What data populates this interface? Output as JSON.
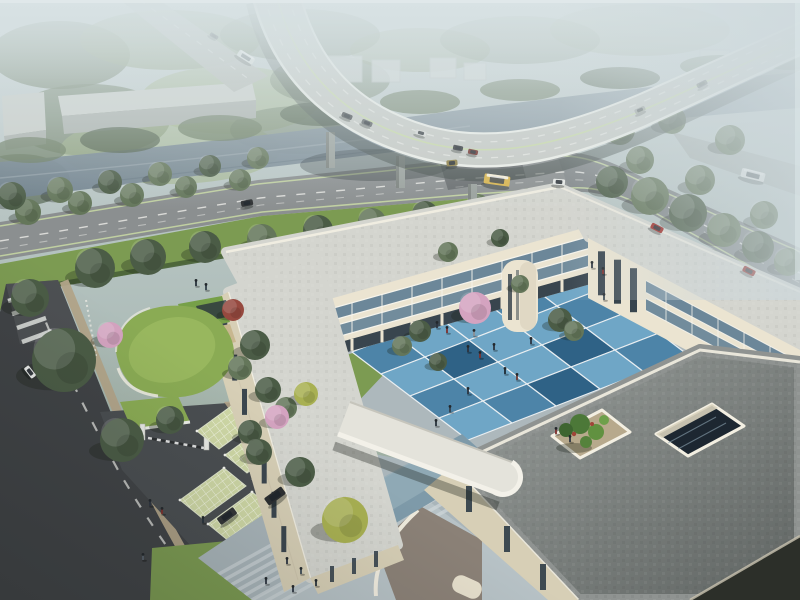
{
  "meta": {
    "type": "aerial-architectural-rendering",
    "subject": "bird's-eye visualization of a three-story cream courtyard building complex with blue checkered courtyard, green roofs, grass-grid parking, riverside forest and a curving highway viaduct with traffic"
  },
  "palette": {
    "haze_top": "#c9d3d5",
    "haze_mid": "#aebdb9",
    "far_green": "#8ea089",
    "tree_dark": "#4b5c46",
    "tree_mid": "#64765a",
    "tree_light": "#7f9166",
    "tree_yellow": "#a8b052",
    "tree_blossom": "#d4a3c0",
    "tree_red": "#96493f",
    "meadow": "#9cb07c",
    "water_light": "#93a2ab",
    "water_dark": "#6f808c",
    "deck": "#c7cac5",
    "deck_edge": "#eef0ea",
    "road_upper": "#8b8f90",
    "road_dark": "#404346",
    "lane_white": "#e8e8e4",
    "lane_green": "#c9dba4",
    "sidewalk": "#b2a489",
    "lawn": "#7c9b52",
    "lawn_dark": "#5e8040",
    "hedge": "#4a6339",
    "grid_park": "#cfd8a6",
    "wall_cream": "#ebe4d1",
    "wall_shade": "#d7cfb6",
    "parapet": "#f3efe2",
    "glass_dark": "#2e3b46",
    "glass_blue": "#6c8799",
    "frame": "#f6f4ec",
    "roof_light": "#d4d5cf",
    "roof_dark": "#8f9391",
    "blue1": "#6fa6c6",
    "blue2": "#4d84a8",
    "blue3": "#2f6286",
    "blue4": "#9cc3d8",
    "green_roof": "#8aab54",
    "gravel": "#b7a98c",
    "plaza": "#a9b5ba",
    "step": "#ccd4d7",
    "bus_yellow": "#d9b54e",
    "car_red": "#9c231d"
  },
  "scene": {
    "trees": [
      {
        "x": 95,
        "y": 268,
        "s": 2.0,
        "t": "dark",
        "layer": "back"
      },
      {
        "x": 148,
        "y": 257,
        "s": 1.8,
        "t": "dark",
        "layer": "back"
      },
      {
        "x": 205,
        "y": 247,
        "s": 1.6,
        "t": "dark",
        "layer": "back"
      },
      {
        "x": 262,
        "y": 239,
        "s": 1.5,
        "t": "mid",
        "layer": "back"
      },
      {
        "x": 318,
        "y": 230,
        "s": 1.5,
        "t": "dark",
        "layer": "back"
      },
      {
        "x": 372,
        "y": 222,
        "s": 1.4,
        "t": "mid",
        "layer": "back"
      },
      {
        "x": 425,
        "y": 214,
        "s": 1.3,
        "t": "dark",
        "layer": "back"
      },
      {
        "x": 478,
        "y": 206,
        "s": 1.2,
        "t": "mid",
        "layer": "back"
      },
      {
        "x": 528,
        "y": 199,
        "s": 1.1,
        "t": "dark",
        "layer": "back"
      },
      {
        "x": 28,
        "y": 212,
        "s": 1.3,
        "t": "mid",
        "layer": "back"
      },
      {
        "x": 80,
        "y": 203,
        "s": 1.2,
        "t": "mid",
        "layer": "back"
      },
      {
        "x": 132,
        "y": 195,
        "s": 1.2,
        "t": "mid",
        "layer": "back"
      },
      {
        "x": 186,
        "y": 187,
        "s": 1.1,
        "t": "mid",
        "layer": "back"
      },
      {
        "x": 240,
        "y": 180,
        "s": 1.1,
        "t": "mid",
        "layer": "back"
      },
      {
        "x": 12,
        "y": 196,
        "s": 1.4,
        "t": "dark",
        "layer": "back"
      },
      {
        "x": 60,
        "y": 190,
        "s": 1.3,
        "t": "mid",
        "layer": "back"
      },
      {
        "x": 110,
        "y": 182,
        "s": 1.2,
        "t": "dark",
        "layer": "back"
      },
      {
        "x": 160,
        "y": 174,
        "s": 1.2,
        "t": "mid",
        "layer": "back"
      },
      {
        "x": 210,
        "y": 166,
        "s": 1.1,
        "t": "dark",
        "layer": "back"
      },
      {
        "x": 258,
        "y": 158,
        "s": 1.1,
        "t": "mid",
        "layer": "back"
      },
      {
        "x": 612,
        "y": 182,
        "s": 1.6,
        "t": "dark",
        "layer": "back"
      },
      {
        "x": 650,
        "y": 196,
        "s": 1.9,
        "t": "mid",
        "layer": "back"
      },
      {
        "x": 688,
        "y": 213,
        "s": 1.9,
        "t": "dark",
        "layer": "back"
      },
      {
        "x": 724,
        "y": 230,
        "s": 1.7,
        "t": "mid",
        "layer": "back"
      },
      {
        "x": 758,
        "y": 247,
        "s": 1.6,
        "t": "dark",
        "layer": "back"
      },
      {
        "x": 788,
        "y": 262,
        "s": 1.4,
        "t": "mid",
        "layer": "back"
      },
      {
        "x": 668,
        "y": 246,
        "s": 1.4,
        "t": "dark",
        "layer": "back"
      },
      {
        "x": 710,
        "y": 262,
        "s": 1.3,
        "t": "mid",
        "layer": "back"
      },
      {
        "x": 745,
        "y": 280,
        "s": 1.3,
        "t": "dark",
        "layer": "back"
      },
      {
        "x": 640,
        "y": 160,
        "s": 1.4,
        "t": "mid",
        "layer": "back"
      },
      {
        "x": 700,
        "y": 180,
        "s": 1.5,
        "t": "mid",
        "layer": "back"
      },
      {
        "x": 764,
        "y": 215,
        "s": 1.4,
        "t": "mid",
        "layer": "back"
      },
      {
        "x": 620,
        "y": 130,
        "s": 1.5,
        "t": "mid",
        "layer": "back"
      },
      {
        "x": 672,
        "y": 120,
        "s": 1.4,
        "t": "mid",
        "layer": "back"
      },
      {
        "x": 730,
        "y": 140,
        "s": 1.5,
        "t": "mid",
        "layer": "back"
      },
      {
        "x": 600,
        "y": 258,
        "s": 1.1,
        "t": "dark",
        "layer": "back"
      },
      {
        "x": 625,
        "y": 272,
        "s": 1.0,
        "t": "mid",
        "layer": "back"
      },
      {
        "x": 233,
        "y": 310,
        "s": 1.1,
        "t": "red",
        "layer": "front"
      },
      {
        "x": 110,
        "y": 335,
        "s": 1.3,
        "t": "blossom",
        "layer": "front"
      },
      {
        "x": 255,
        "y": 345,
        "s": 1.5,
        "t": "dark",
        "layer": "front"
      },
      {
        "x": 240,
        "y": 368,
        "s": 1.2,
        "t": "mid",
        "layer": "front"
      },
      {
        "x": 268,
        "y": 390,
        "s": 1.3,
        "t": "dark",
        "layer": "front"
      },
      {
        "x": 286,
        "y": 408,
        "s": 1.1,
        "t": "mid",
        "layer": "front"
      },
      {
        "x": 277,
        "y": 417,
        "s": 1.2,
        "t": "blossom",
        "layer": "front"
      },
      {
        "x": 306,
        "y": 394,
        "s": 1.2,
        "t": "yellow",
        "layer": "front"
      },
      {
        "x": 122,
        "y": 440,
        "s": 2.2,
        "t": "dark",
        "layer": "front"
      },
      {
        "x": 64,
        "y": 360,
        "s": 3.2,
        "t": "dark",
        "layer": "front"
      },
      {
        "x": 30,
        "y": 298,
        "s": 1.9,
        "t": "dark",
        "layer": "front"
      },
      {
        "x": 250,
        "y": 432,
        "s": 1.2,
        "t": "dark",
        "layer": "front"
      },
      {
        "x": 345,
        "y": 520,
        "s": 2.3,
        "t": "yellow",
        "layer": "front"
      },
      {
        "x": 300,
        "y": 472,
        "s": 1.5,
        "t": "dark",
        "layer": "front"
      },
      {
        "x": 259,
        "y": 452,
        "s": 1.3,
        "t": "dark",
        "layer": "front"
      },
      {
        "x": 475,
        "y": 308,
        "s": 1.6,
        "t": "blossom",
        "layer": "front"
      },
      {
        "x": 520,
        "y": 284,
        "s": 0.9,
        "t": "mid",
        "layer": "front"
      },
      {
        "x": 420,
        "y": 331,
        "s": 1.1,
        "t": "dark",
        "layer": "front"
      },
      {
        "x": 402,
        "y": 346,
        "s": 1.0,
        "t": "mid",
        "layer": "front"
      },
      {
        "x": 560,
        "y": 320,
        "s": 1.2,
        "t": "dark",
        "layer": "front"
      },
      {
        "x": 574,
        "y": 331,
        "s": 1.0,
        "t": "mid",
        "layer": "front"
      },
      {
        "x": 438,
        "y": 362,
        "s": 0.9,
        "t": "dark",
        "layer": "front"
      },
      {
        "x": 170,
        "y": 420,
        "s": 1.4,
        "t": "dark",
        "layer": "front"
      },
      {
        "x": 448,
        "y": 252,
        "s": 1.0,
        "t": "mid",
        "layer": "front"
      },
      {
        "x": 500,
        "y": 238,
        "s": 0.9,
        "t": "dark",
        "layer": "front"
      }
    ],
    "vehicles": [
      {
        "x": 347,
        "y": 116,
        "r": 22,
        "l": 11,
        "w": 5,
        "b": "#3b3e41"
      },
      {
        "x": 367,
        "y": 123,
        "r": 22,
        "l": 11,
        "w": 5,
        "b": "#53575a"
      },
      {
        "x": 421,
        "y": 133,
        "r": 16,
        "l": 11,
        "w": 5,
        "b": "#d9dad7"
      },
      {
        "x": 458,
        "y": 148,
        "r": 12,
        "l": 10,
        "w": 5,
        "b": "#303336"
      },
      {
        "x": 473,
        "y": 152,
        "r": 12,
        "l": 10,
        "w": 5,
        "b": "#6e2b26"
      },
      {
        "x": 640,
        "y": 110,
        "r": -24,
        "l": 11,
        "w": 5,
        "b": "#8f9290",
        "o": 0.8
      },
      {
        "x": 702,
        "y": 84,
        "r": -27,
        "l": 11,
        "w": 5,
        "b": "#44474a",
        "o": 0.7
      },
      {
        "x": 497,
        "y": 180,
        "r": 8,
        "l": 26,
        "w": 10,
        "b": "#d9b54e",
        "g": "#43484d",
        "k": "bus"
      },
      {
        "x": 559,
        "y": 182,
        "r": 4,
        "l": 12,
        "w": 6,
        "b": "#e8eae7"
      },
      {
        "x": 452,
        "y": 163,
        "r": -6,
        "l": 11,
        "w": 6,
        "b": "#8a7a3e"
      },
      {
        "x": 247,
        "y": 203,
        "r": -10,
        "l": 12,
        "w": 6,
        "b": "#2f3234"
      },
      {
        "x": 657,
        "y": 228,
        "r": 27,
        "l": 13,
        "w": 6,
        "b": "#9c231d"
      },
      {
        "x": 749,
        "y": 271,
        "r": 27,
        "l": 13,
        "w": 6,
        "b": "#8f201b"
      },
      {
        "x": 753,
        "y": 175,
        "r": 14,
        "l": 24,
        "w": 9,
        "b": "#e9ebe8",
        "g": "#4a5258",
        "k": "bus",
        "o": 0.85
      },
      {
        "x": 246,
        "y": 57,
        "r": 32,
        "l": 18,
        "w": 7,
        "b": "#e3e5e2",
        "g": "#566066",
        "k": "bus"
      },
      {
        "x": 214,
        "y": 36,
        "r": 32,
        "l": 9,
        "w": 4,
        "b": "#3d4144"
      },
      {
        "x": 30,
        "y": 372,
        "r": 52,
        "l": 13,
        "w": 6,
        "b": "#eaecea"
      },
      {
        "x": 275,
        "y": 496,
        "r": -36,
        "l": 21,
        "w": 9,
        "b": "#2c2f31"
      },
      {
        "x": 227,
        "y": 516,
        "r": -36,
        "l": 20,
        "w": 8,
        "b": "#323537"
      }
    ],
    "people": [
      {
        "x": 468,
        "y": 352,
        "c": "#2c3440"
      },
      {
        "x": 480,
        "y": 358,
        "c": "#7e2f2c"
      },
      {
        "x": 494,
        "y": 350,
        "c": "#2c3440"
      },
      {
        "x": 505,
        "y": 374,
        "c": "#1f2a33"
      },
      {
        "x": 517,
        "y": 380,
        "c": "#6e3a34"
      },
      {
        "x": 468,
        "y": 394,
        "c": "#2c3440"
      },
      {
        "x": 450,
        "y": 412,
        "c": "#37424d"
      },
      {
        "x": 436,
        "y": 426,
        "c": "#27313b"
      },
      {
        "x": 531,
        "y": 344,
        "c": "#2c3440"
      },
      {
        "x": 556,
        "y": 434,
        "c": "#7e2f2c"
      },
      {
        "x": 570,
        "y": 442,
        "c": "#2c3440"
      },
      {
        "x": 604,
        "y": 300,
        "c": "#34414c"
      },
      {
        "x": 474,
        "y": 336,
        "c": "#8c8f93"
      },
      {
        "x": 437,
        "y": 328,
        "c": "#2c3440"
      },
      {
        "x": 447,
        "y": 333,
        "c": "#7e2f2c"
      },
      {
        "x": 150,
        "y": 506,
        "c": "#2c3440"
      },
      {
        "x": 162,
        "y": 514,
        "c": "#7e2f2c"
      },
      {
        "x": 203,
        "y": 523,
        "c": "#27313b"
      },
      {
        "x": 143,
        "y": 560,
        "c": "#57616b"
      },
      {
        "x": 287,
        "y": 564,
        "c": "#2c3440"
      },
      {
        "x": 301,
        "y": 574,
        "c": "#3c4a56"
      },
      {
        "x": 316,
        "y": 586,
        "c": "#27313b"
      },
      {
        "x": 293,
        "y": 592,
        "c": "#2c3440"
      },
      {
        "x": 266,
        "y": 584,
        "c": "#2c3440"
      },
      {
        "x": 592,
        "y": 268,
        "c": "#2c3440"
      },
      {
        "x": 603,
        "y": 274,
        "c": "#7e2f2c"
      },
      {
        "x": 206,
        "y": 290,
        "c": "#33404a"
      },
      {
        "x": 196,
        "y": 286,
        "c": "#27313b"
      }
    ]
  }
}
